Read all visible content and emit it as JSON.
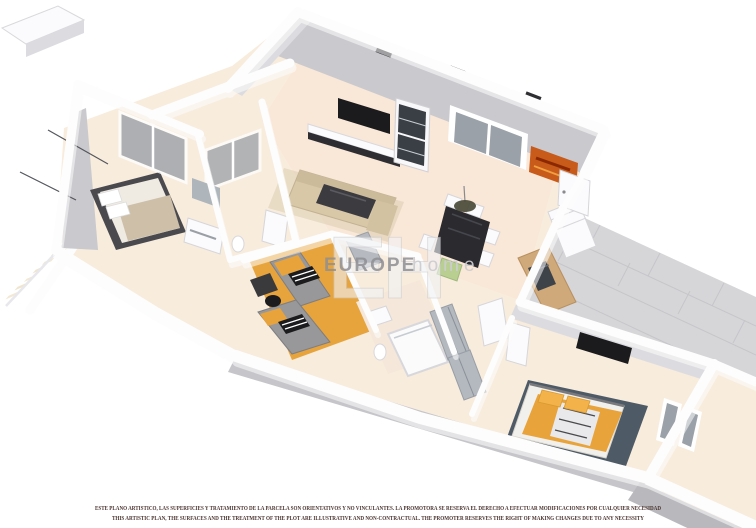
{
  "watermark": {
    "logo": "EH",
    "brand_bold": "EUROPE",
    "brand_light": "home"
  },
  "disclaimer": {
    "line1_es": "ESTE PLANO ARTISTICO, LAS SUPERFICIES Y TRATAMIENTO DE LA PARCELA SON ORIENTATIVOS Y NO VINCULANTES. LA PROMOTORA SE RESERVA EL DERECHO A EFECTUAR MODIFICACIONES POR CUALQUIER NECESIDAD",
    "line2_en": "THIS ARTISTIC PLAN, THE SURFACES AND THE TREATMENT OF THE PLOT ARE ILLUSTRATIVE AND NON-CONTRACTUAL. THE PROMOTER RESERVES THE RIGHT OF MAKING CHANGES DUE TO ANY NECESSITY"
  },
  "colors": {
    "background": "#ffffff",
    "wall_white": "#fdfdfd",
    "wall_face": "#c9c9ce",
    "wall_shadow": "#c4c4c9",
    "floor": "#f8ecdd",
    "floor_warm": "#f9e4d4",
    "terrace": "#f6ebd2",
    "patio": "#d6d6d9",
    "patio_grout": "#c6c6ca",
    "kids_floor": "#e7a43c",
    "accent_orange": "#e8a33b",
    "rug": "#4e5a66",
    "dark_furniture": "#2e2e32",
    "tv_black": "#1b1b1d",
    "sofa": "#d8c8a8",
    "wood": "#cfa97a",
    "glass": "#9ba1a8",
    "green_chair": "#b9cf92",
    "art_orange": "#c85a1a",
    "watermark_gray": "#8f8f94",
    "disclaimer": "#4a3430"
  }
}
